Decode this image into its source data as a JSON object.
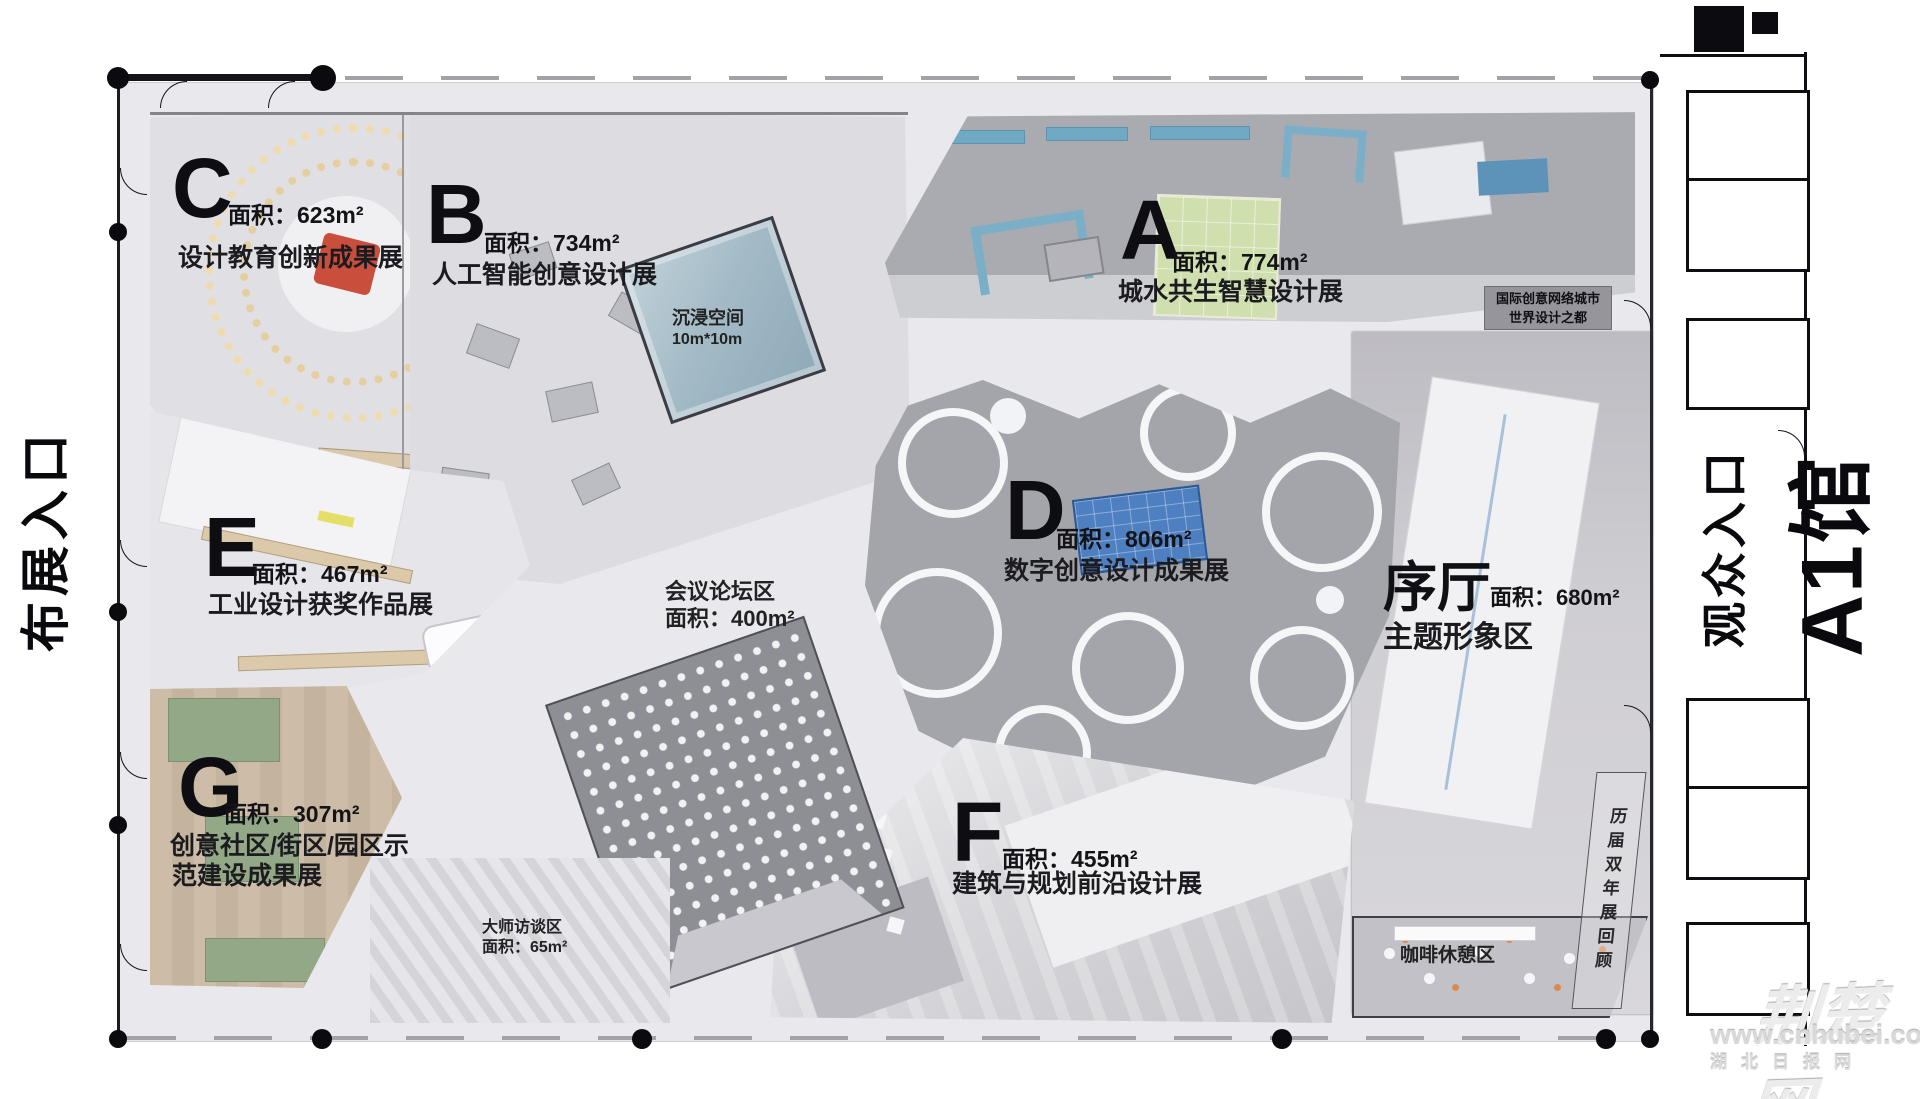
{
  "entrances": {
    "left": "布展入口",
    "right": "观众入口",
    "hall": "A1馆"
  },
  "zones": [
    {
      "letter": "C",
      "area": "面积：623m²",
      "name": "设计教育创新成果展"
    },
    {
      "letter": "B",
      "area": "面积：734m²",
      "name": "人工智能创意设计展"
    },
    {
      "letter": "A",
      "area": "面积：774m²",
      "name": "城水共生智慧设计展"
    },
    {
      "letter": "D",
      "area": "面积：806m²",
      "name": "数字创意设计成果展"
    },
    {
      "letter": "E",
      "area": "面积：467m²",
      "name": "工业设计获奖作品展"
    },
    {
      "letter": "F",
      "area": "面积：455m²",
      "name": "建筑与规划前沿设计展"
    },
    {
      "letter": "G",
      "area": "面积：307m²",
      "name": "创意社区/街区/园区示",
      "name2": "范建设成果展"
    }
  ],
  "foyer": {
    "title": "序厅",
    "area": "面积：680m²",
    "name": "主题形象区"
  },
  "areas": {
    "conference1": "会议论坛区",
    "conference2": "面积：400m²",
    "master1": "大师访谈区",
    "master2": "面积：65m²",
    "immersive1": "沉浸空间",
    "immersive2": "10m*10m",
    "cafe": "咖啡休憩区",
    "biennale": "历届双年展回顾",
    "badge1": "国际创意网络城市",
    "badge2": "世界设计之都"
  },
  "watermark": {
    "logo": "荆楚网",
    "url": "www.cnhubei.com",
    "caption": "湖北日报网"
  }
}
